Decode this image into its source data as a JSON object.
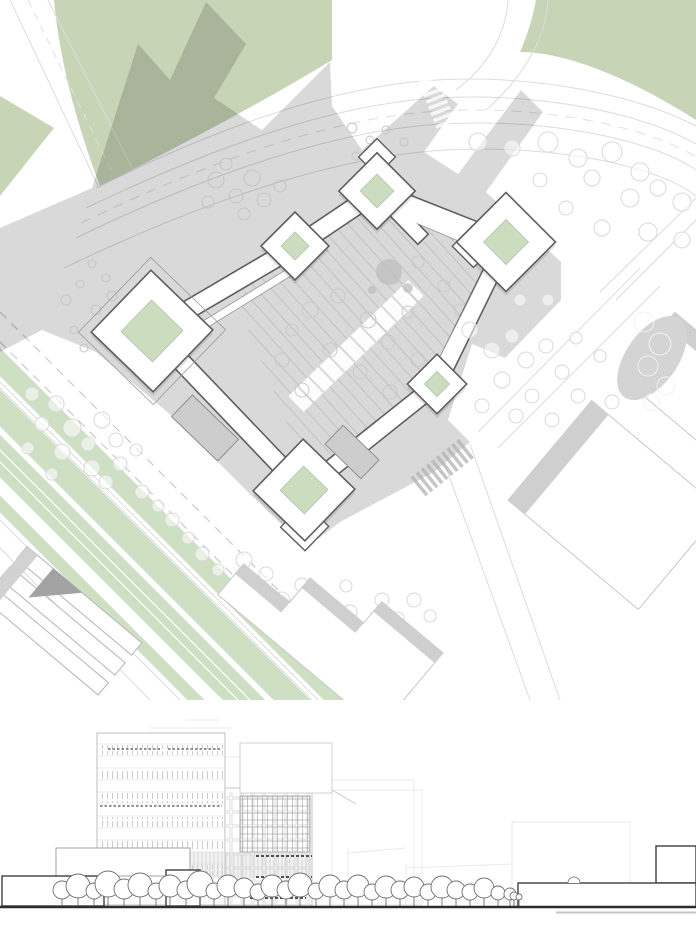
{
  "canvas": {
    "w": 696,
    "h": 929
  },
  "colors": {
    "paper": "#ffffff",
    "field_green": "#c8d4b6",
    "stripe_green": "#cfdfc3",
    "court_green": "#cbdcbf",
    "shadow_opacity": "0.15",
    "road_line": "#dcdcdc",
    "road_dash": "#cacaca",
    "plaza_stripe": "#c2c2c2",
    "bar_outline": "#5e5e5e",
    "bar_liner": "#909090",
    "bar_fill": "#ffffff",
    "annex_gray": "#cdcdcd",
    "annex_edge": "#8f8f8f",
    "neighbor_line": "#c7c7c7",
    "neighbor_band": "#cfcfcf",
    "corner_dark": "#a2a2a2",
    "tree_light": "#d9d9d9",
    "tree_shadow": "#c5c5c5",
    "tree_plaza": "#c9c9c9",
    "blob_gray": "#bdbdbd",
    "cluster_gray": "#d4d4d4",
    "cluster_tree": "#f2f2f2",
    "cross_gray": "#b3b3b3",
    "elev_faint": "#e3e3e3",
    "elev_light": "#c9c9c9",
    "elev_mid": "#9d9d9d",
    "elev_dark": "#3e3e3e",
    "elev_tree": "#6f6f6f",
    "ground": "#2c2c2c"
  },
  "site": {
    "pavilions": [
      {
        "cx": 377,
        "cy": 191,
        "rot": 45,
        "outer": 54,
        "court": 24,
        "annex": {
          "dx": -24,
          "dy": -24,
          "w": 26,
          "h": 26
        }
      },
      {
        "cx": 295,
        "cy": 246,
        "rot": 45,
        "outer": 48,
        "court": 20
      },
      {
        "cx": 152,
        "cy": 331,
        "rot": 44,
        "outer": 86,
        "court": 44,
        "outer2": 104
      },
      {
        "cx": 506,
        "cy": 242,
        "rot": 45,
        "outer": 70,
        "court": 32,
        "annex": {
          "dx": -20,
          "dy": 26,
          "w": 30,
          "h": 30
        }
      },
      {
        "cx": 437,
        "cy": 384,
        "rot": 45,
        "outer": 42,
        "court": 18
      },
      {
        "cx": 304,
        "cy": 490,
        "rot": 44,
        "outer": 72,
        "court": 34,
        "annex": {
          "dx": 26,
          "dy": 26,
          "w": 34,
          "h": 34
        }
      }
    ],
    "bars": [
      {
        "x1": 152,
        "y1": 331,
        "x2": 295,
        "y2": 247,
        "w": 17
      },
      {
        "x1": 295,
        "y1": 247,
        "x2": 377,
        "y2": 192,
        "w": 17
      },
      {
        "x1": 377,
        "y1": 192,
        "x2": 506,
        "y2": 243,
        "w": 17
      },
      {
        "x1": 506,
        "y1": 243,
        "x2": 437,
        "y2": 384,
        "w": 16
      },
      {
        "x1": 437,
        "y1": 384,
        "x2": 304,
        "y2": 490,
        "w": 16
      },
      {
        "x1": 304,
        "y1": 490,
        "x2": 152,
        "y2": 331,
        "w": 17
      },
      {
        "x1": 377,
        "y1": 192,
        "x2": 418,
        "y2": 234,
        "w": 13
      }
    ],
    "liners": [
      [
        170,
        346,
        306,
        262,
        7
      ],
      [
        390,
        208,
        514,
        260,
        7
      ],
      [
        494,
        258,
        436,
        372,
        6
      ],
      [
        428,
        394,
        312,
        482,
        6
      ]
    ],
    "annexes": [
      {
        "cx": 205,
        "cy": 428,
        "rot": 44,
        "w": 64,
        "h": 30
      },
      {
        "cx": 352,
        "cy": 452,
        "rot": 44,
        "w": 50,
        "h": 26
      }
    ],
    "trees_light": [
      [
        478,
        142,
        9
      ],
      [
        512,
        148,
        8
      ],
      [
        548,
        142,
        10
      ],
      [
        578,
        158,
        9
      ],
      [
        612,
        152,
        10
      ],
      [
        640,
        172,
        9
      ],
      [
        592,
        178,
        8
      ],
      [
        630,
        198,
        9
      ],
      [
        658,
        188,
        8
      ],
      [
        682,
        202,
        9
      ],
      [
        602,
        228,
        8
      ],
      [
        648,
        232,
        9
      ],
      [
        682,
        240,
        8
      ],
      [
        566,
        208,
        7
      ],
      [
        540,
        180,
        7
      ],
      [
        32,
        394,
        7
      ],
      [
        56,
        404,
        8
      ],
      [
        42,
        424,
        7
      ],
      [
        72,
        428,
        9
      ],
      [
        28,
        448,
        6
      ],
      [
        62,
        452,
        8
      ],
      [
        88,
        444,
        7
      ],
      [
        102,
        420,
        8
      ],
      [
        116,
        440,
        7
      ],
      [
        92,
        468,
        8
      ],
      [
        52,
        474,
        6
      ],
      [
        120,
        464,
        7
      ],
      [
        136,
        450,
        6
      ],
      [
        106,
        482,
        7
      ],
      [
        142,
        492,
        7
      ],
      [
        158,
        506,
        6
      ],
      [
        172,
        520,
        7
      ],
      [
        188,
        538,
        6
      ],
      [
        202,
        554,
        7
      ],
      [
        218,
        570,
        6
      ],
      [
        236,
        584,
        7
      ],
      [
        252,
        600,
        6
      ],
      [
        268,
        614,
        7
      ],
      [
        286,
        630,
        6
      ],
      [
        302,
        644,
        7
      ],
      [
        318,
        658,
        6
      ],
      [
        244,
        560,
        8
      ],
      [
        266,
        574,
        7
      ],
      [
        252,
        592,
        7
      ],
      [
        282,
        600,
        8
      ],
      [
        302,
        585,
        7
      ],
      [
        316,
        606,
        8
      ],
      [
        332,
        620,
        7
      ],
      [
        296,
        636,
        7
      ],
      [
        350,
        612,
        7
      ],
      [
        366,
        630,
        7
      ],
      [
        346,
        586,
        6
      ],
      [
        382,
        600,
        7
      ],
      [
        398,
        618,
        6
      ],
      [
        414,
        600,
        7
      ],
      [
        430,
        616,
        6
      ],
      [
        470,
        330,
        8
      ],
      [
        492,
        350,
        8
      ],
      [
        512,
        336,
        7
      ],
      [
        526,
        360,
        8
      ],
      [
        546,
        346,
        7
      ],
      [
        502,
        380,
        8
      ],
      [
        532,
        396,
        7
      ],
      [
        562,
        372,
        7
      ],
      [
        482,
        406,
        7
      ],
      [
        516,
        416,
        7
      ],
      [
        552,
        420,
        7
      ],
      [
        578,
        396,
        7
      ],
      [
        592,
        420,
        6
      ],
      [
        612,
        402,
        7
      ],
      [
        628,
        382,
        6
      ],
      [
        600,
        356,
        6
      ],
      [
        576,
        338,
        6
      ],
      [
        548,
        300,
        6
      ],
      [
        520,
        300,
        6
      ]
    ],
    "trees_shadow": [
      [
        66,
        300,
        5
      ],
      [
        80,
        284,
        4
      ],
      [
        96,
        310,
        5
      ],
      [
        74,
        330,
        4
      ],
      [
        112,
        296,
        5
      ],
      [
        126,
        316,
        4
      ],
      [
        92,
        264,
        4
      ],
      [
        106,
        278,
        4
      ],
      [
        140,
        300,
        5
      ],
      [
        132,
        332,
        4
      ],
      [
        156,
        292,
        4
      ],
      [
        170,
        312,
        4
      ],
      [
        118,
        340,
        4
      ],
      [
        84,
        348,
        4
      ],
      [
        216,
        180,
        8
      ],
      [
        236,
        196,
        7
      ],
      [
        252,
        178,
        8
      ],
      [
        264,
        200,
        7
      ],
      [
        226,
        164,
        6
      ],
      [
        280,
        186,
        6
      ],
      [
        244,
        214,
        6
      ],
      [
        208,
        202,
        6
      ],
      [
        352,
        128,
        5
      ],
      [
        370,
        140,
        4
      ],
      [
        386,
        130,
        4
      ],
      [
        404,
        142,
        4
      ],
      [
        356,
        156,
        4
      ],
      [
        378,
        162,
        4
      ]
    ],
    "trees_plaza": [
      [
        310,
        310,
        8
      ],
      [
        338,
        296,
        7
      ],
      [
        368,
        320,
        8
      ],
      [
        330,
        350,
        7
      ],
      [
        388,
        342,
        7
      ],
      [
        360,
        372,
        7
      ],
      [
        408,
        312,
        6
      ],
      [
        418,
        360,
        7
      ],
      [
        390,
        392,
        7
      ],
      [
        428,
        392,
        6
      ],
      [
        302,
        390,
        7
      ],
      [
        282,
        360,
        7
      ],
      [
        292,
        330,
        6
      ],
      [
        418,
        262,
        6
      ],
      [
        444,
        286,
        6
      ],
      [
        460,
        310,
        6
      ]
    ],
    "blob": [
      [
        389,
        272,
        13
      ],
      [
        408,
        288,
        5
      ],
      [
        372,
        290,
        4
      ]
    ],
    "cluster_trees": [
      [
        644,
        322,
        10
      ],
      [
        660,
        344,
        11
      ],
      [
        648,
        366,
        10
      ],
      [
        666,
        386,
        9
      ],
      [
        652,
        402,
        8
      ]
    ]
  },
  "elevation": {
    "bands": [
      [
        45,
        10
      ],
      [
        69,
        10
      ],
      [
        93,
        10
      ],
      [
        117,
        10
      ],
      [
        141,
        10
      ],
      [
        165,
        10
      ]
    ],
    "floors": [
      44,
      56,
      68,
      80,
      92,
      104,
      116,
      128,
      140,
      152,
      164,
      176,
      188
    ],
    "dark_rows": [
      [
        108,
        160,
        49
      ],
      [
        168,
        220,
        49
      ],
      [
        100,
        222,
        106
      ],
      [
        100,
        310,
        190
      ]
    ],
    "right_dark_rows": [
      [
        256,
        312,
        156
      ],
      [
        256,
        312,
        177
      ],
      [
        250,
        306,
        198
      ]
    ],
    "bg_rects": [
      [
        310,
        90,
        112,
        115
      ],
      [
        332,
        80,
        82,
        125
      ],
      [
        512,
        122,
        118,
        83
      ]
    ],
    "bg_lines": [
      [
        200,
        118,
        310,
        118
      ],
      [
        348,
        153,
        406,
        148
      ],
      [
        406,
        168,
        512,
        164
      ],
      [
        348,
        148,
        348,
        205
      ],
      [
        406,
        164,
        406,
        205
      ],
      [
        200,
        57,
        310,
        57
      ],
      [
        150,
        28,
        232,
        28
      ],
      [
        186,
        20,
        218,
        20
      ]
    ],
    "trees": [
      [
        62,
        190,
        9
      ],
      [
        78,
        186,
        12
      ],
      [
        94,
        191,
        8
      ],
      [
        108,
        184,
        13
      ],
      [
        124,
        189,
        10
      ],
      [
        140,
        185,
        12
      ],
      [
        156,
        191,
        8
      ],
      [
        170,
        186,
        11
      ],
      [
        186,
        190,
        9
      ],
      [
        200,
        184,
        13
      ],
      [
        214,
        191,
        8
      ],
      [
        228,
        186,
        11
      ],
      [
        244,
        188,
        10
      ],
      [
        258,
        192,
        8
      ],
      [
        272,
        186,
        11
      ],
      [
        286,
        190,
        9
      ],
      [
        300,
        185,
        12
      ],
      [
        316,
        191,
        8
      ],
      [
        330,
        186,
        11
      ],
      [
        344,
        190,
        9
      ],
      [
        358,
        186,
        11
      ],
      [
        372,
        192,
        8
      ],
      [
        386,
        187,
        11
      ],
      [
        400,
        190,
        9
      ],
      [
        414,
        187,
        10
      ],
      [
        428,
        192,
        8
      ],
      [
        442,
        187,
        11
      ],
      [
        456,
        190,
        9
      ],
      [
        470,
        192,
        8
      ],
      [
        484,
        188,
        10
      ],
      [
        498,
        193,
        7
      ],
      [
        510,
        194,
        6
      ],
      [
        514,
        196,
        4
      ],
      [
        519,
        197,
        3
      ]
    ]
  }
}
